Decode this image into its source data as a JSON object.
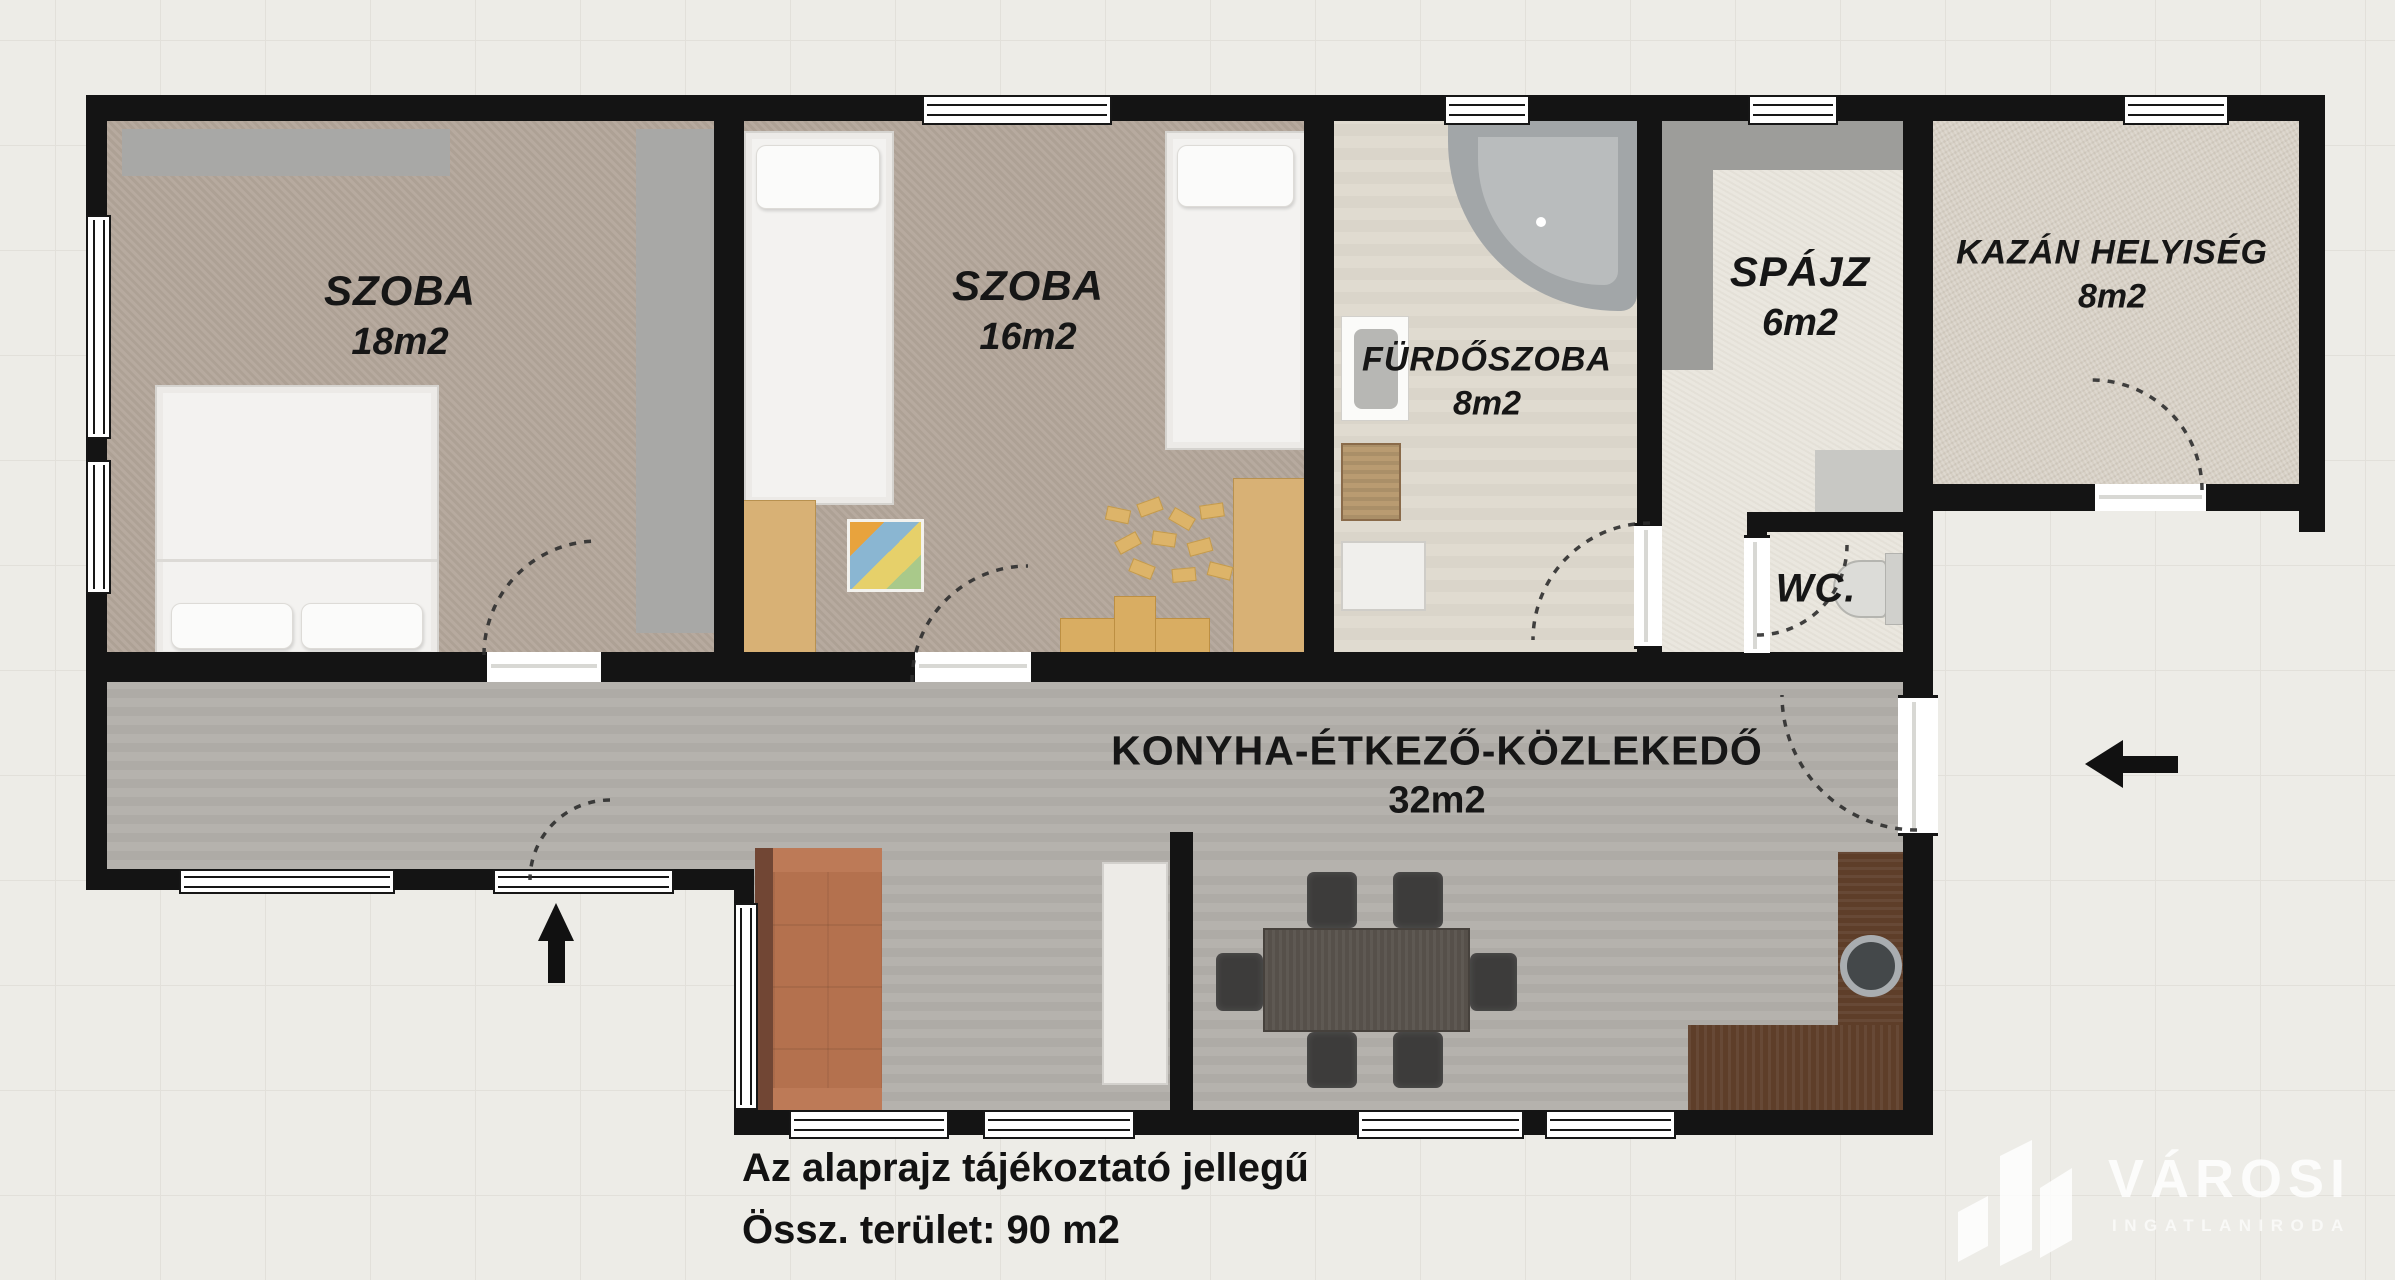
{
  "rooms": [
    {
      "name": "SZOBA",
      "area": "18m2"
    },
    {
      "name": "SZOBA",
      "area": "16m2"
    },
    {
      "name": "FÜRDŐSZOBA",
      "area": "8m2"
    },
    {
      "name": "SPÁJZ",
      "area": "6m2"
    },
    {
      "name": "WC."
    },
    {
      "name": "KAZÁN HELYISÉG",
      "area": "8m2"
    },
    {
      "name": "KONYHA-ÉTKEZŐ-KÖZLEKEDŐ",
      "area": "32m2"
    }
  ],
  "caption": {
    "line1": "Az alaprajz tájékoztató jellegű",
    "line2": "Össz. terület: 90 m2"
  },
  "logo": {
    "title": "VÁROSI",
    "subtitle": "INGATLANIRODA"
  },
  "icons": {
    "entrance_side": "left-arrow",
    "entrance_bottom": "up-arrow",
    "door_swings": "dashed-quarter-arcs"
  },
  "colors": {
    "wall": "#141414",
    "carpet": "#b3a69a",
    "corridor_floor": "#b2afaa",
    "bath_floor": "#ded9ce",
    "pantry_floor": "#eae7df",
    "boiler_floor": "#d7d0c5",
    "couch": "#b4714e",
    "kitchen_counter": "#5e3e29",
    "wood_accent": "#d8b175",
    "background": "#edece7"
  }
}
